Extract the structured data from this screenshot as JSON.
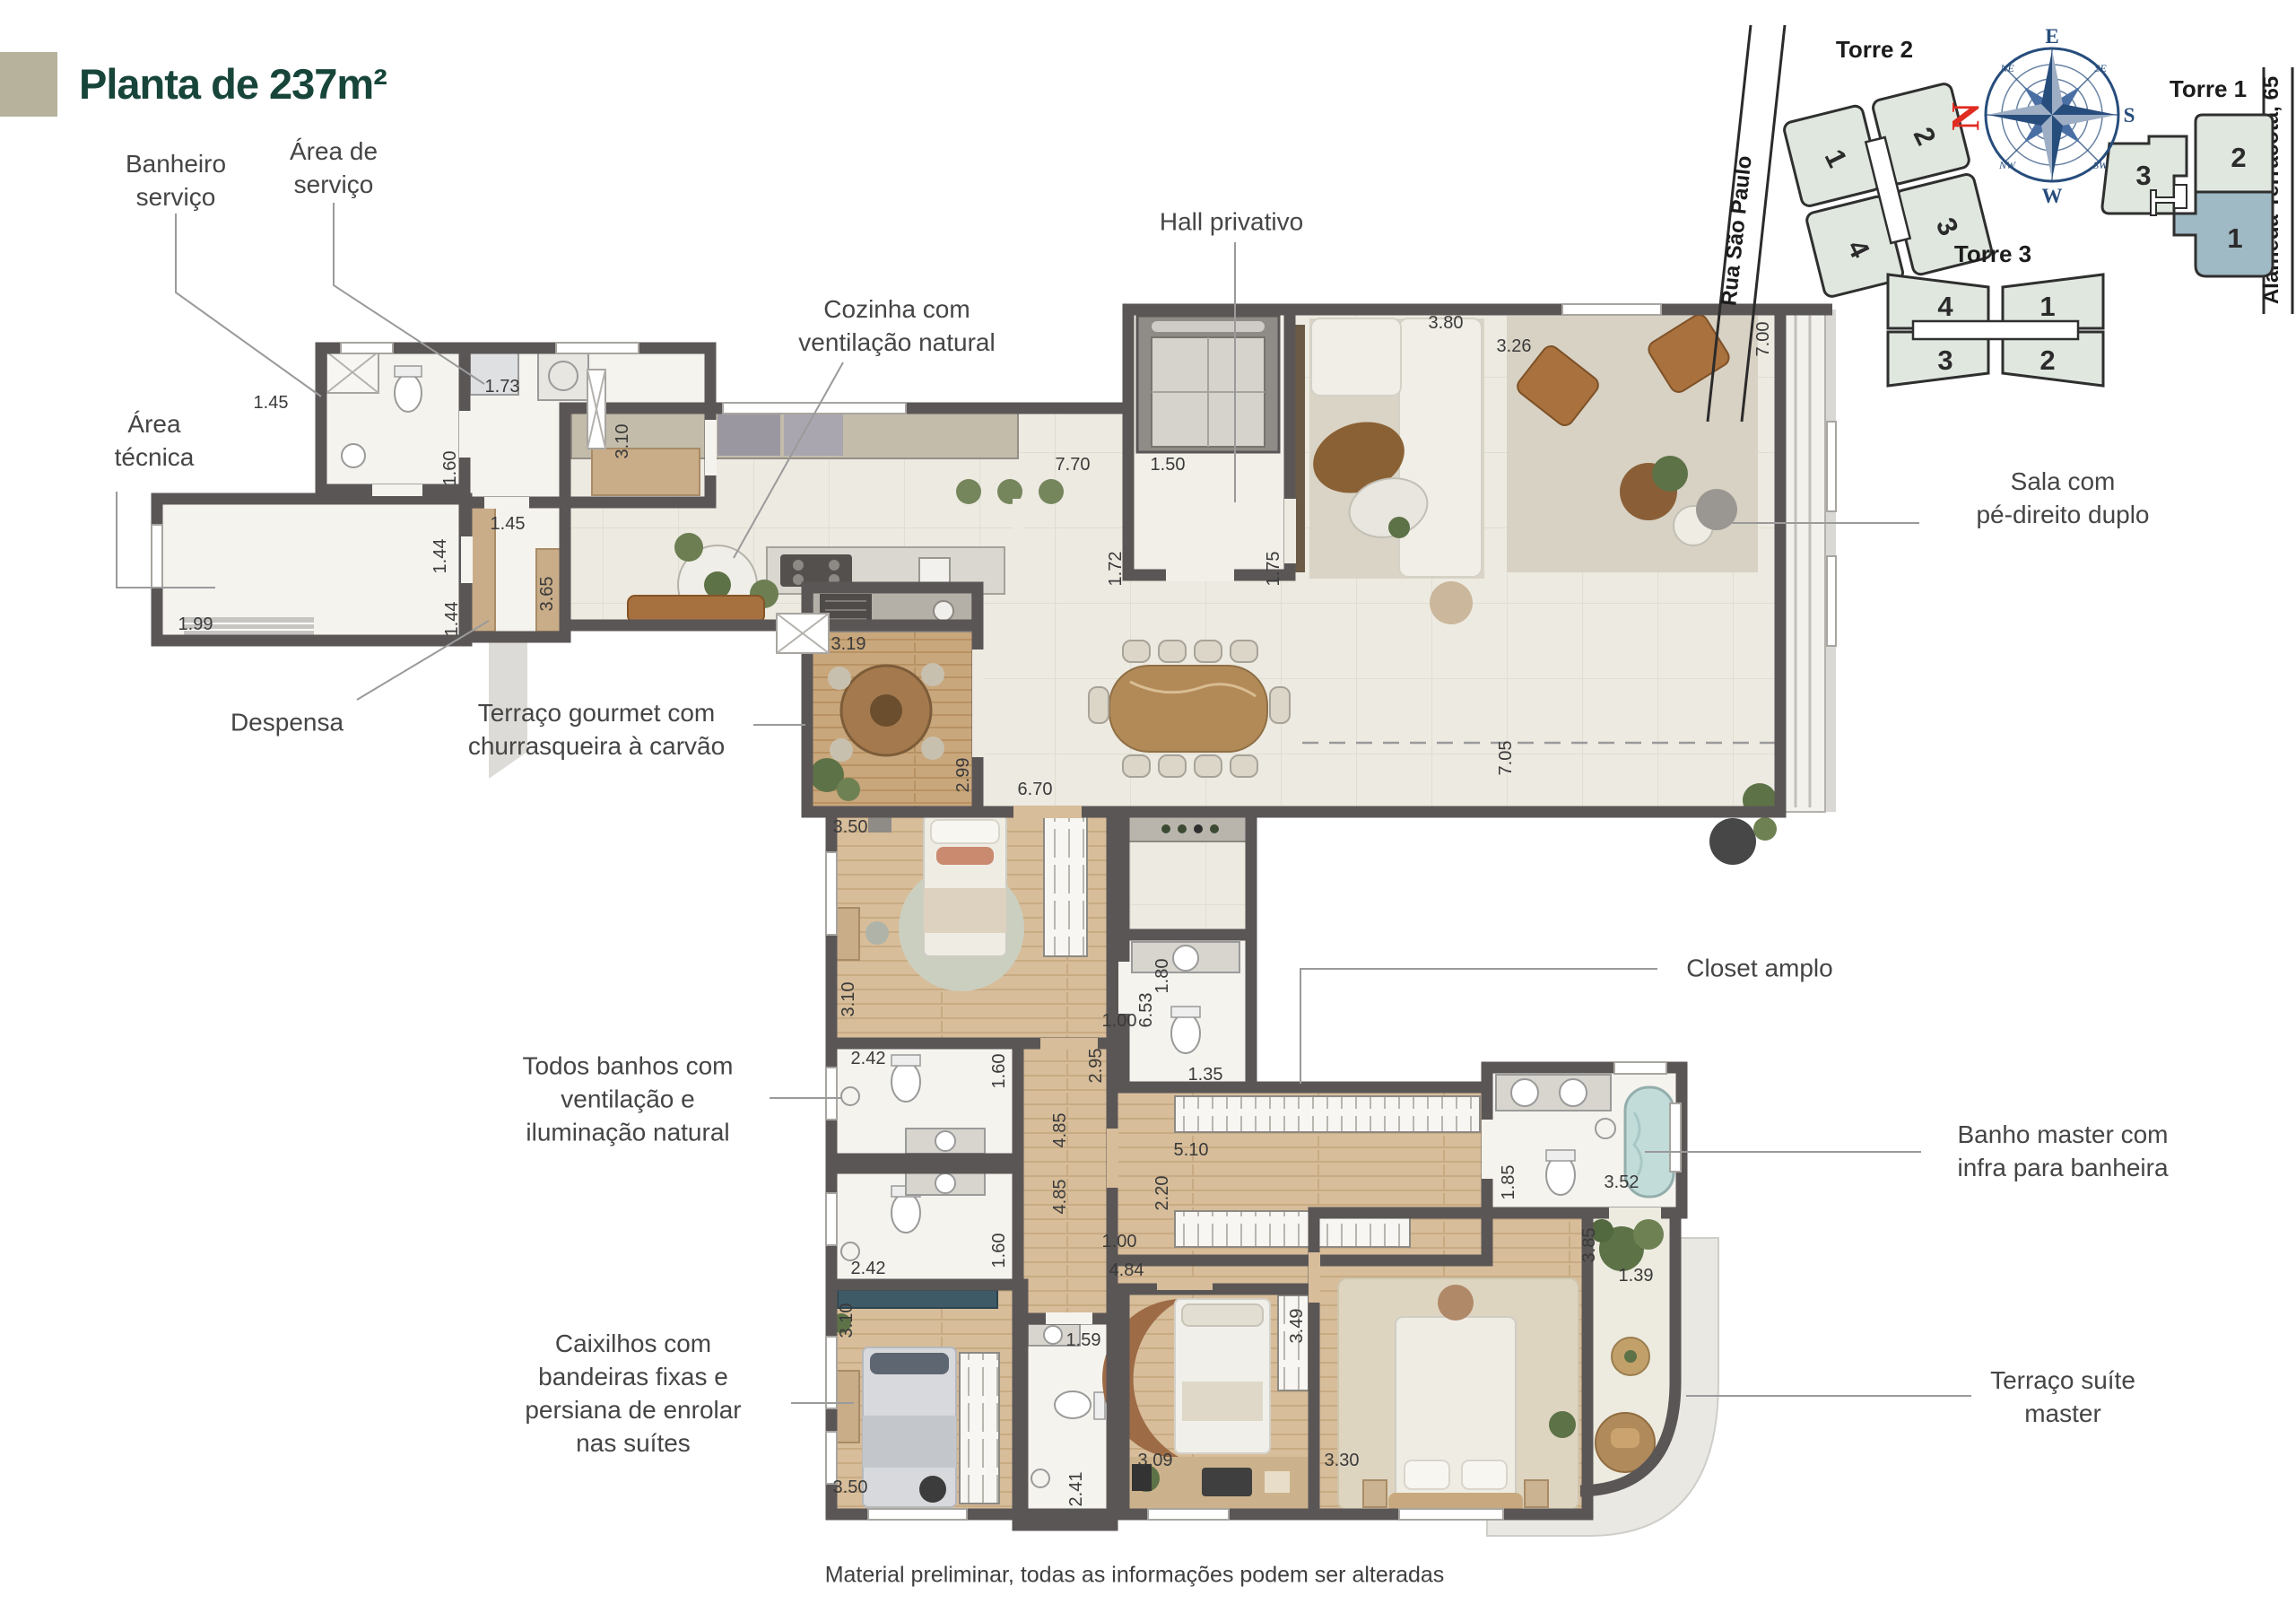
{
  "title": "Planta de 237m²",
  "footer": "Material preliminar, todas as informações podem ser alteradas",
  "callouts": {
    "banheiro_servico": "Banheiro\nserviço",
    "area_servico": "Área de\nserviço",
    "cozinha": "Cozinha com\nventilação natural",
    "hall_privativo": "Hall privativo",
    "area_tecnica": "Área\ntécnica",
    "despensa": "Despensa",
    "terraco_gourmet": "Terraço gourmet com\nchurrasqueira à carvão",
    "sala": "Sala com\npé-direito duplo",
    "closet": "Closet amplo",
    "banhos": "Todos banhos com\nventilação e\niluminação natural",
    "banho_master": "Banho master com\ninfra para banheira",
    "caixilhos": "Caixilhos com\nbandeiras fixas e\npersiana de enrolar\nnas suítes",
    "terraco_master": "Terraço suíte\nmaster"
  },
  "dims": [
    "1.45",
    "1.73",
    "1.60",
    "1.45",
    "1.44",
    "1.44",
    "1.99",
    "3.65",
    "3.10",
    "7.70",
    "1.50",
    "1.72",
    "1.75",
    "3.80",
    "3.26",
    "7.00",
    "3.19",
    "2.99",
    "6.70",
    "7.05",
    "3.50",
    "3.10",
    "2.42",
    "1.60",
    "2.42",
    "1.60",
    "4.85",
    "4.85",
    "1.00",
    "2.95",
    "6.53",
    "1.80",
    "1.35",
    "5.10",
    "2.20",
    "1.00",
    "4.84",
    "1.85",
    "3.52",
    "3.85",
    "1.39",
    "3.10",
    "3.50",
    "1.59",
    "2.41",
    "3.09",
    "3.49",
    "3.30"
  ],
  "site_plan": {
    "streets": {
      "rua": "Rua São Paulo",
      "alameda": "Alameda Terracota, 65"
    },
    "towers": [
      {
        "name": "Torre 2",
        "units": [
          "1",
          "2",
          "4",
          "3"
        ]
      },
      {
        "name": "Torre 3",
        "units": [
          "4",
          "1",
          "3",
          "2"
        ]
      },
      {
        "name": "Torre 1",
        "units": [
          "2",
          "3",
          "1"
        ],
        "highlighted_unit": "1"
      }
    ],
    "compass": {
      "n": "N",
      "e": "E",
      "s": "S",
      "w": "W",
      "ne": "NE",
      "se": "SE",
      "sw": "SW",
      "nw": "NW"
    }
  },
  "colors": {
    "title_green": "#17453a",
    "wall_gray": "#5b5656",
    "accent_beige": "#b7b29c",
    "tower_fill": "#dfe7df",
    "unit_highlight": "#9fb9c5",
    "compass_blue": "#274d7c",
    "north_red": "#e02b20"
  }
}
